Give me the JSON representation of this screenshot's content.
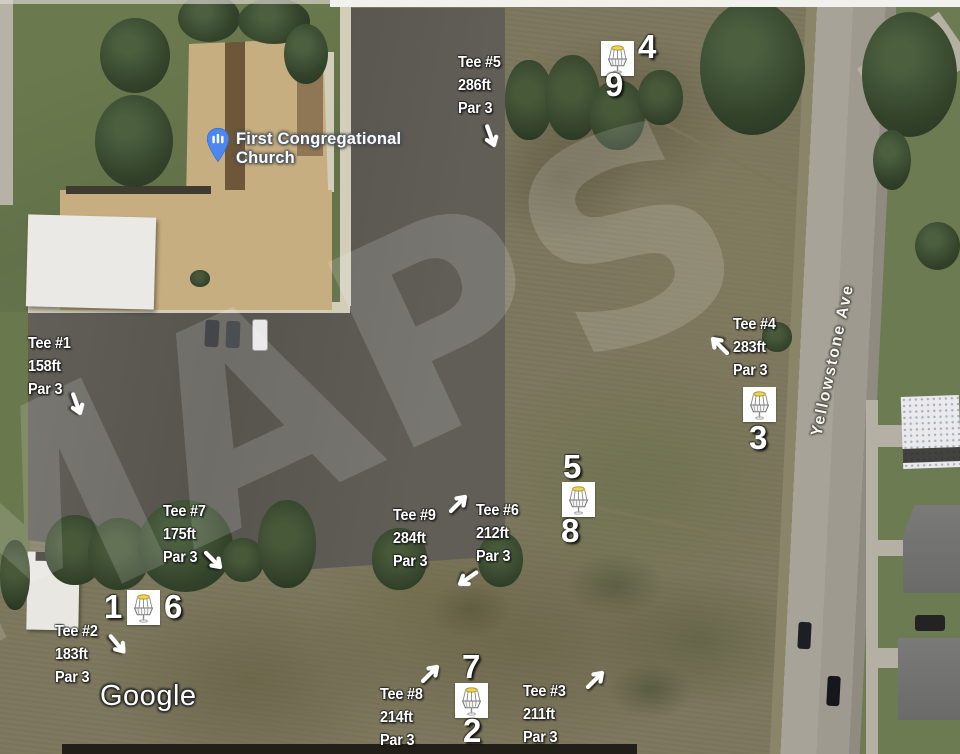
{
  "map": {
    "provider_watermark": "Google",
    "diagonal_watermark": "MAPS",
    "poi": {
      "name_line1": "First Congregational",
      "name_line2": "Church"
    },
    "street": {
      "name": "Yellowstone Ave"
    }
  },
  "course": {
    "tees": [
      {
        "label": "Tee #1",
        "distance": "158ft",
        "par": "Par 3",
        "x": 28,
        "y": 332,
        "arrow": {
          "x": 64,
          "y": 392,
          "rot": 115
        }
      },
      {
        "label": "Tee #2",
        "distance": "183ft",
        "par": "Par 3",
        "x": 55,
        "y": 620,
        "arrow": {
          "x": 105,
          "y": 632,
          "rot": 95
        }
      },
      {
        "label": "Tee #3",
        "distance": "211ft",
        "par": "Par 3",
        "x": 523,
        "y": 680,
        "arrow": {
          "x": 583,
          "y": 666,
          "rot": 0
        }
      },
      {
        "label": "Tee #4",
        "distance": "283ft",
        "par": "Par 3",
        "x": 733,
        "y": 313,
        "arrow": {
          "x": 706,
          "y": 332,
          "rot": 270
        }
      },
      {
        "label": "Tee #5",
        "distance": "286ft",
        "par": "Par 3",
        "x": 458,
        "y": 51,
        "arrow": {
          "x": 478,
          "y": 124,
          "rot": 115
        }
      },
      {
        "label": "Tee #6",
        "distance": "212ft",
        "par": "Par 3",
        "x": 476,
        "y": 499,
        "arrow": {
          "x": 454,
          "y": 566,
          "rot": 190
        }
      },
      {
        "label": "Tee #7",
        "distance": "175ft",
        "par": "Par 3",
        "x": 163,
        "y": 500,
        "arrow": {
          "x": 201,
          "y": 548,
          "rot": 90
        }
      },
      {
        "label": "Tee #8",
        "distance": "214ft",
        "par": "Par 3",
        "x": 380,
        "y": 683,
        "arrow": {
          "x": 418,
          "y": 660,
          "rot": 0
        }
      },
      {
        "label": "Tee #9",
        "distance": "284ft",
        "par": "Par 3",
        "x": 393,
        "y": 504,
        "arrow": {
          "x": 446,
          "y": 490,
          "rot": 0
        }
      }
    ],
    "baskets": [
      {
        "x": 601,
        "y": 41,
        "numbers": [
          {
            "t": "4",
            "x": 638,
            "y": 30
          },
          {
            "t": "9",
            "x": 605,
            "y": 68
          }
        ]
      },
      {
        "x": 743,
        "y": 387,
        "numbers": [
          {
            "t": "3",
            "x": 749,
            "y": 421
          }
        ]
      },
      {
        "x": 562,
        "y": 482,
        "numbers": [
          {
            "t": "5",
            "x": 563,
            "y": 450
          },
          {
            "t": "8",
            "x": 561,
            "y": 514
          }
        ]
      },
      {
        "x": 127,
        "y": 590,
        "numbers": [
          {
            "t": "1",
            "x": 104,
            "y": 590
          },
          {
            "t": "6",
            "x": 164,
            "y": 590
          }
        ]
      },
      {
        "x": 455,
        "y": 683,
        "numbers": [
          {
            "t": "7",
            "x": 462,
            "y": 650
          },
          {
            "t": "2",
            "x": 463,
            "y": 714
          }
        ]
      }
    ]
  },
  "colors": {
    "annotation_text": "#ffffff",
    "poi_marker_blue": "#4a87f0",
    "basket_band_yellow": "#ead64f"
  }
}
